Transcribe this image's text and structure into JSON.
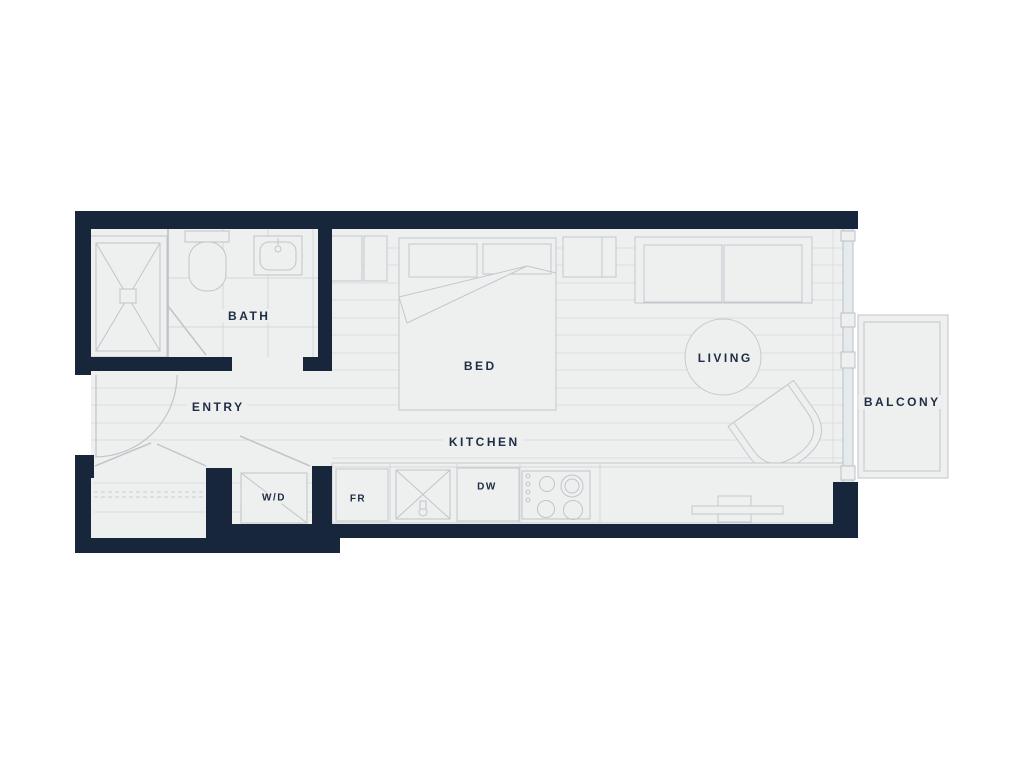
{
  "plan": {
    "type": "studio-apartment-floor-plan",
    "rooms": {
      "bath": "BATH",
      "entry": "ENTRY",
      "bed": "BED",
      "kitchen": "KITCHEN",
      "living": "LIVING",
      "balcony": "BALCONY"
    },
    "appliances": {
      "washer_dryer": "W/D",
      "fridge": "FR",
      "dishwasher": "DW"
    },
    "colors": {
      "wall": "#18263c",
      "floor": "#eef0f0",
      "floor_line": "#dadde0",
      "fixture_line": "#c3c8cc",
      "label": "#1e2c44",
      "background": "#ffffff"
    }
  }
}
